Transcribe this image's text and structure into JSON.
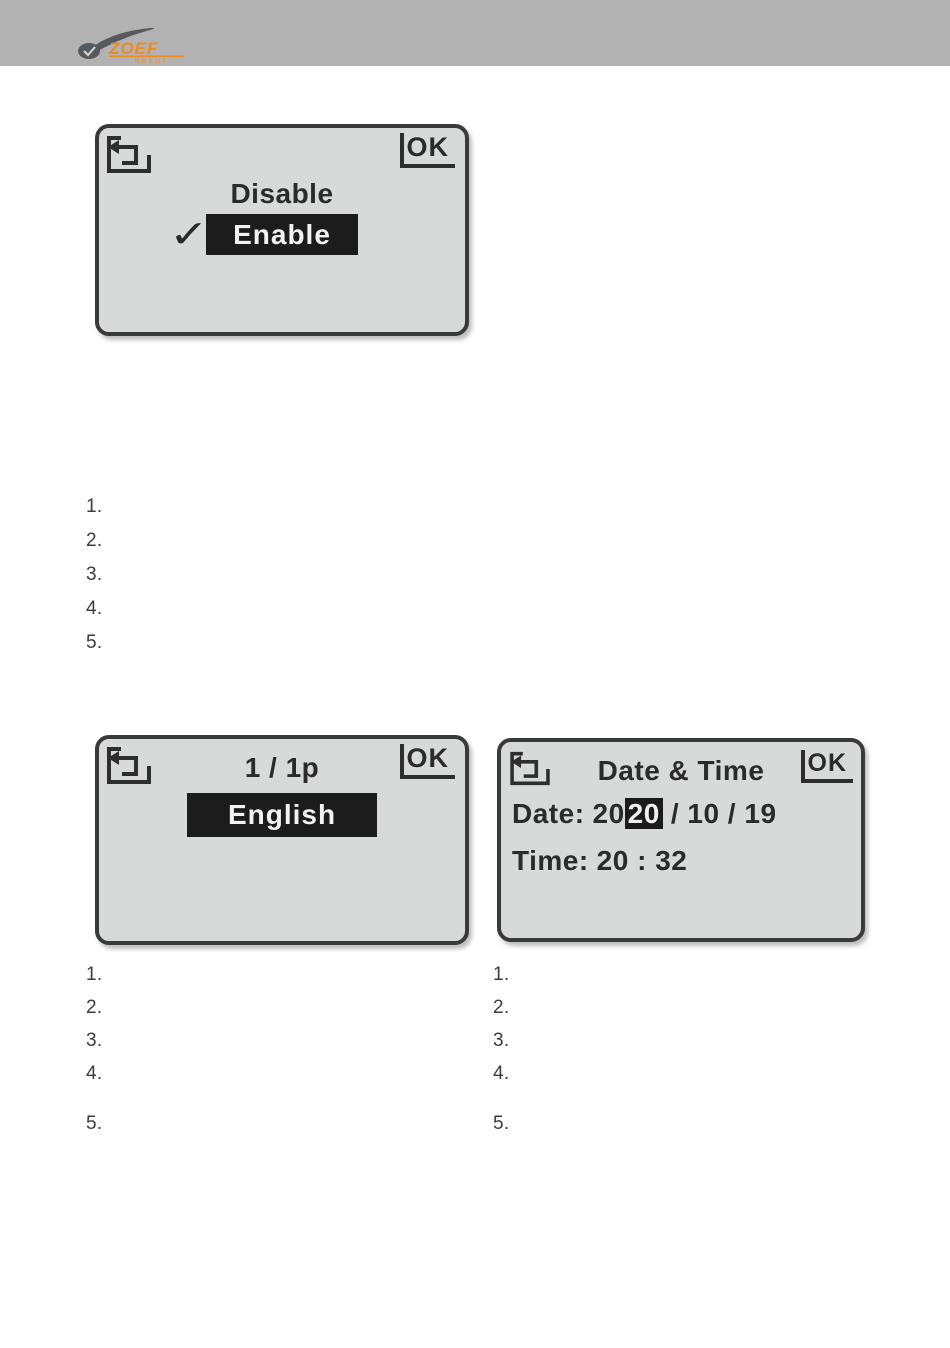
{
  "header": {
    "logo": {
      "brand": "ZOEF",
      "sub": "ROBOT"
    }
  },
  "screens": {
    "enable_select": {
      "ok_label": "OK",
      "option_unselected": "Disable",
      "option_selected": "Enable",
      "checkmark": "✓"
    },
    "language_select": {
      "title": "1 / 1p",
      "ok_label": "OK",
      "option_selected": "English"
    },
    "date_time": {
      "title": "Date & Time",
      "ok_label": "OK",
      "date_label": "Date:",
      "date_year_prefix": "20",
      "date_year_highlighted": "20",
      "date_suffix": "/ 10 / 19",
      "time_label": "Time:",
      "time_value": "20 : 32"
    }
  },
  "lists": {
    "top": {
      "items": [
        "1.",
        "2.",
        "3.",
        "4.",
        "5."
      ]
    },
    "bottom_left": {
      "items": [
        "1.",
        "2.",
        "3.",
        "4.",
        "5."
      ]
    },
    "bottom_right": {
      "items": [
        "1.",
        "2.",
        "3.",
        "4.",
        "5."
      ]
    }
  },
  "colors": {
    "header_bar": "#b2b2b2",
    "logo_orange": "#ee8b20",
    "logo_gray": "#565a5e",
    "lcd_background": "#d8d9d9",
    "lcd_border": "#3a3a3a",
    "lcd_text": "#2b2b2b",
    "highlight_background": "#1c1c1c",
    "highlight_text": "#f2f2f2"
  }
}
